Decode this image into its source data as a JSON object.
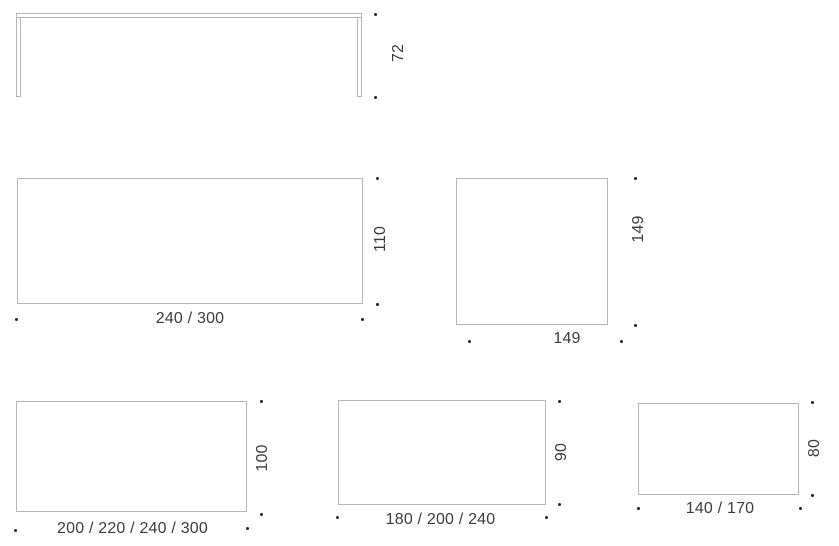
{
  "sheet": {
    "type": "furniture-dimension-drawings",
    "colors": {
      "line": "#b2b6b8",
      "text": "#3b3b42",
      "dot": "#212126",
      "background": "#ffffff"
    },
    "drawings": {
      "side_elevation": {
        "name": "table side view",
        "height": "72"
      },
      "top_view_large": {
        "name": "rectangular top 240/300 x 110",
        "width": "240 / 300",
        "height": "110"
      },
      "top_view_square": {
        "name": "square top 149 x 149",
        "width": "149",
        "height": "149"
      },
      "top_view_100": {
        "name": "rectangular top 200/220/240/300 x 100",
        "width": "200 / 220 / 240 / 300",
        "height": "100"
      },
      "top_view_90": {
        "name": "rectangular top 180/200/240 x 90",
        "width": "180 / 200 / 240",
        "height": "90"
      },
      "top_view_80": {
        "name": "rectangular top 140/170 x 80",
        "width": "140 / 170",
        "height": "80"
      }
    }
  }
}
